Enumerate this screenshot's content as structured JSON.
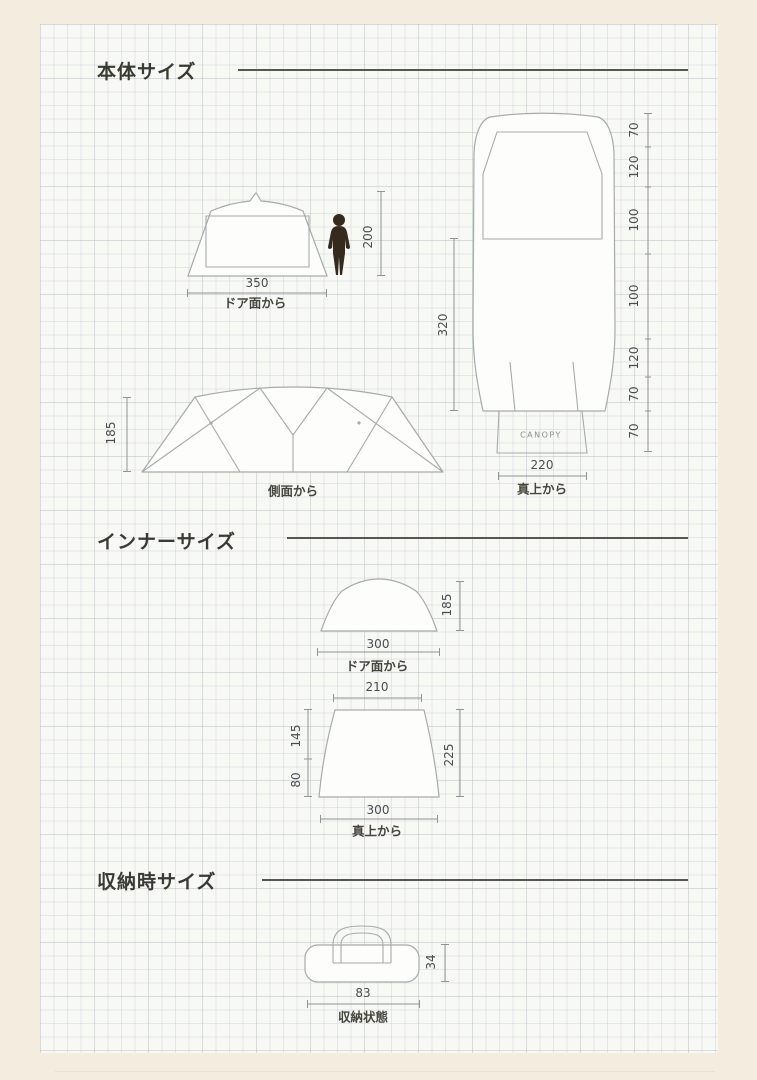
{
  "page": {
    "outer_bg": "#f5ece0",
    "panel_bg": "#f8f8f5",
    "accent_line": "#565650"
  },
  "sections": {
    "body": {
      "title": "本体サイズ"
    },
    "inner": {
      "title": "インナーサイズ"
    },
    "storage": {
      "title": "収納時サイズ"
    }
  },
  "body_front": {
    "width": "350",
    "caption": "ドア面から",
    "person_height": "200"
  },
  "body_top": {
    "depth": "320",
    "width": "220",
    "caption": "真上から",
    "canopy": "CANOPY",
    "segments": [
      "70",
      "120",
      "100",
      "100",
      "120",
      "70",
      "70"
    ]
  },
  "body_side": {
    "height": "185",
    "caption": "側面から"
  },
  "inner_front": {
    "width": "300",
    "height": "185",
    "caption": "ドア面から"
  },
  "inner_top": {
    "top_width": "210",
    "bottom_width": "300",
    "depth_upper": "145",
    "depth_lower": "80",
    "depth_total": "225",
    "caption": "真上から"
  },
  "storage_bag": {
    "width": "83",
    "height": "34",
    "caption": "収納状態"
  }
}
